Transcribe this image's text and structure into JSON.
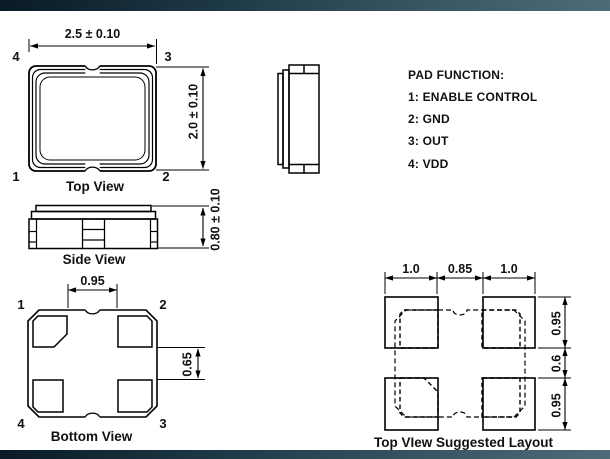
{
  "header_bar": {
    "gradient_left": "#091b26",
    "gradient_right": "#4d6b79"
  },
  "footer_bar": {
    "gradient_left": "#091b26",
    "gradient_right": "#4d6b79"
  },
  "line_color": "#000000",
  "top_view": {
    "caption": "Top View",
    "width_dim": "2.5 ± 0.10",
    "height_dim": "2.0 ± 0.10",
    "pad_labels": {
      "top_left": "4",
      "top_right": "3",
      "bottom_left": "1",
      "bottom_right": "2"
    }
  },
  "side_view": {
    "caption": "Side View",
    "height_dim": "0.80 ± 0.10"
  },
  "pad_function": {
    "title": "PAD FUNCTION:",
    "lines": [
      "1: ENABLE CONTROL",
      "2: GND",
      "3: OUT",
      "4: VDD"
    ]
  },
  "bottom_view": {
    "caption": "Bottom View",
    "horizontal_dim": "0.95",
    "vertical_dim": "0.65",
    "pad_labels": {
      "top_left": "1",
      "top_right": "2",
      "bottom_left": "4",
      "bottom_right": "3"
    }
  },
  "suggested_layout": {
    "caption": "Top VIew Suggested Layout",
    "top_dims": [
      "1.0",
      "0.85",
      "1.0"
    ],
    "side_dims": [
      "0.95",
      "0.6",
      "0.95"
    ]
  }
}
